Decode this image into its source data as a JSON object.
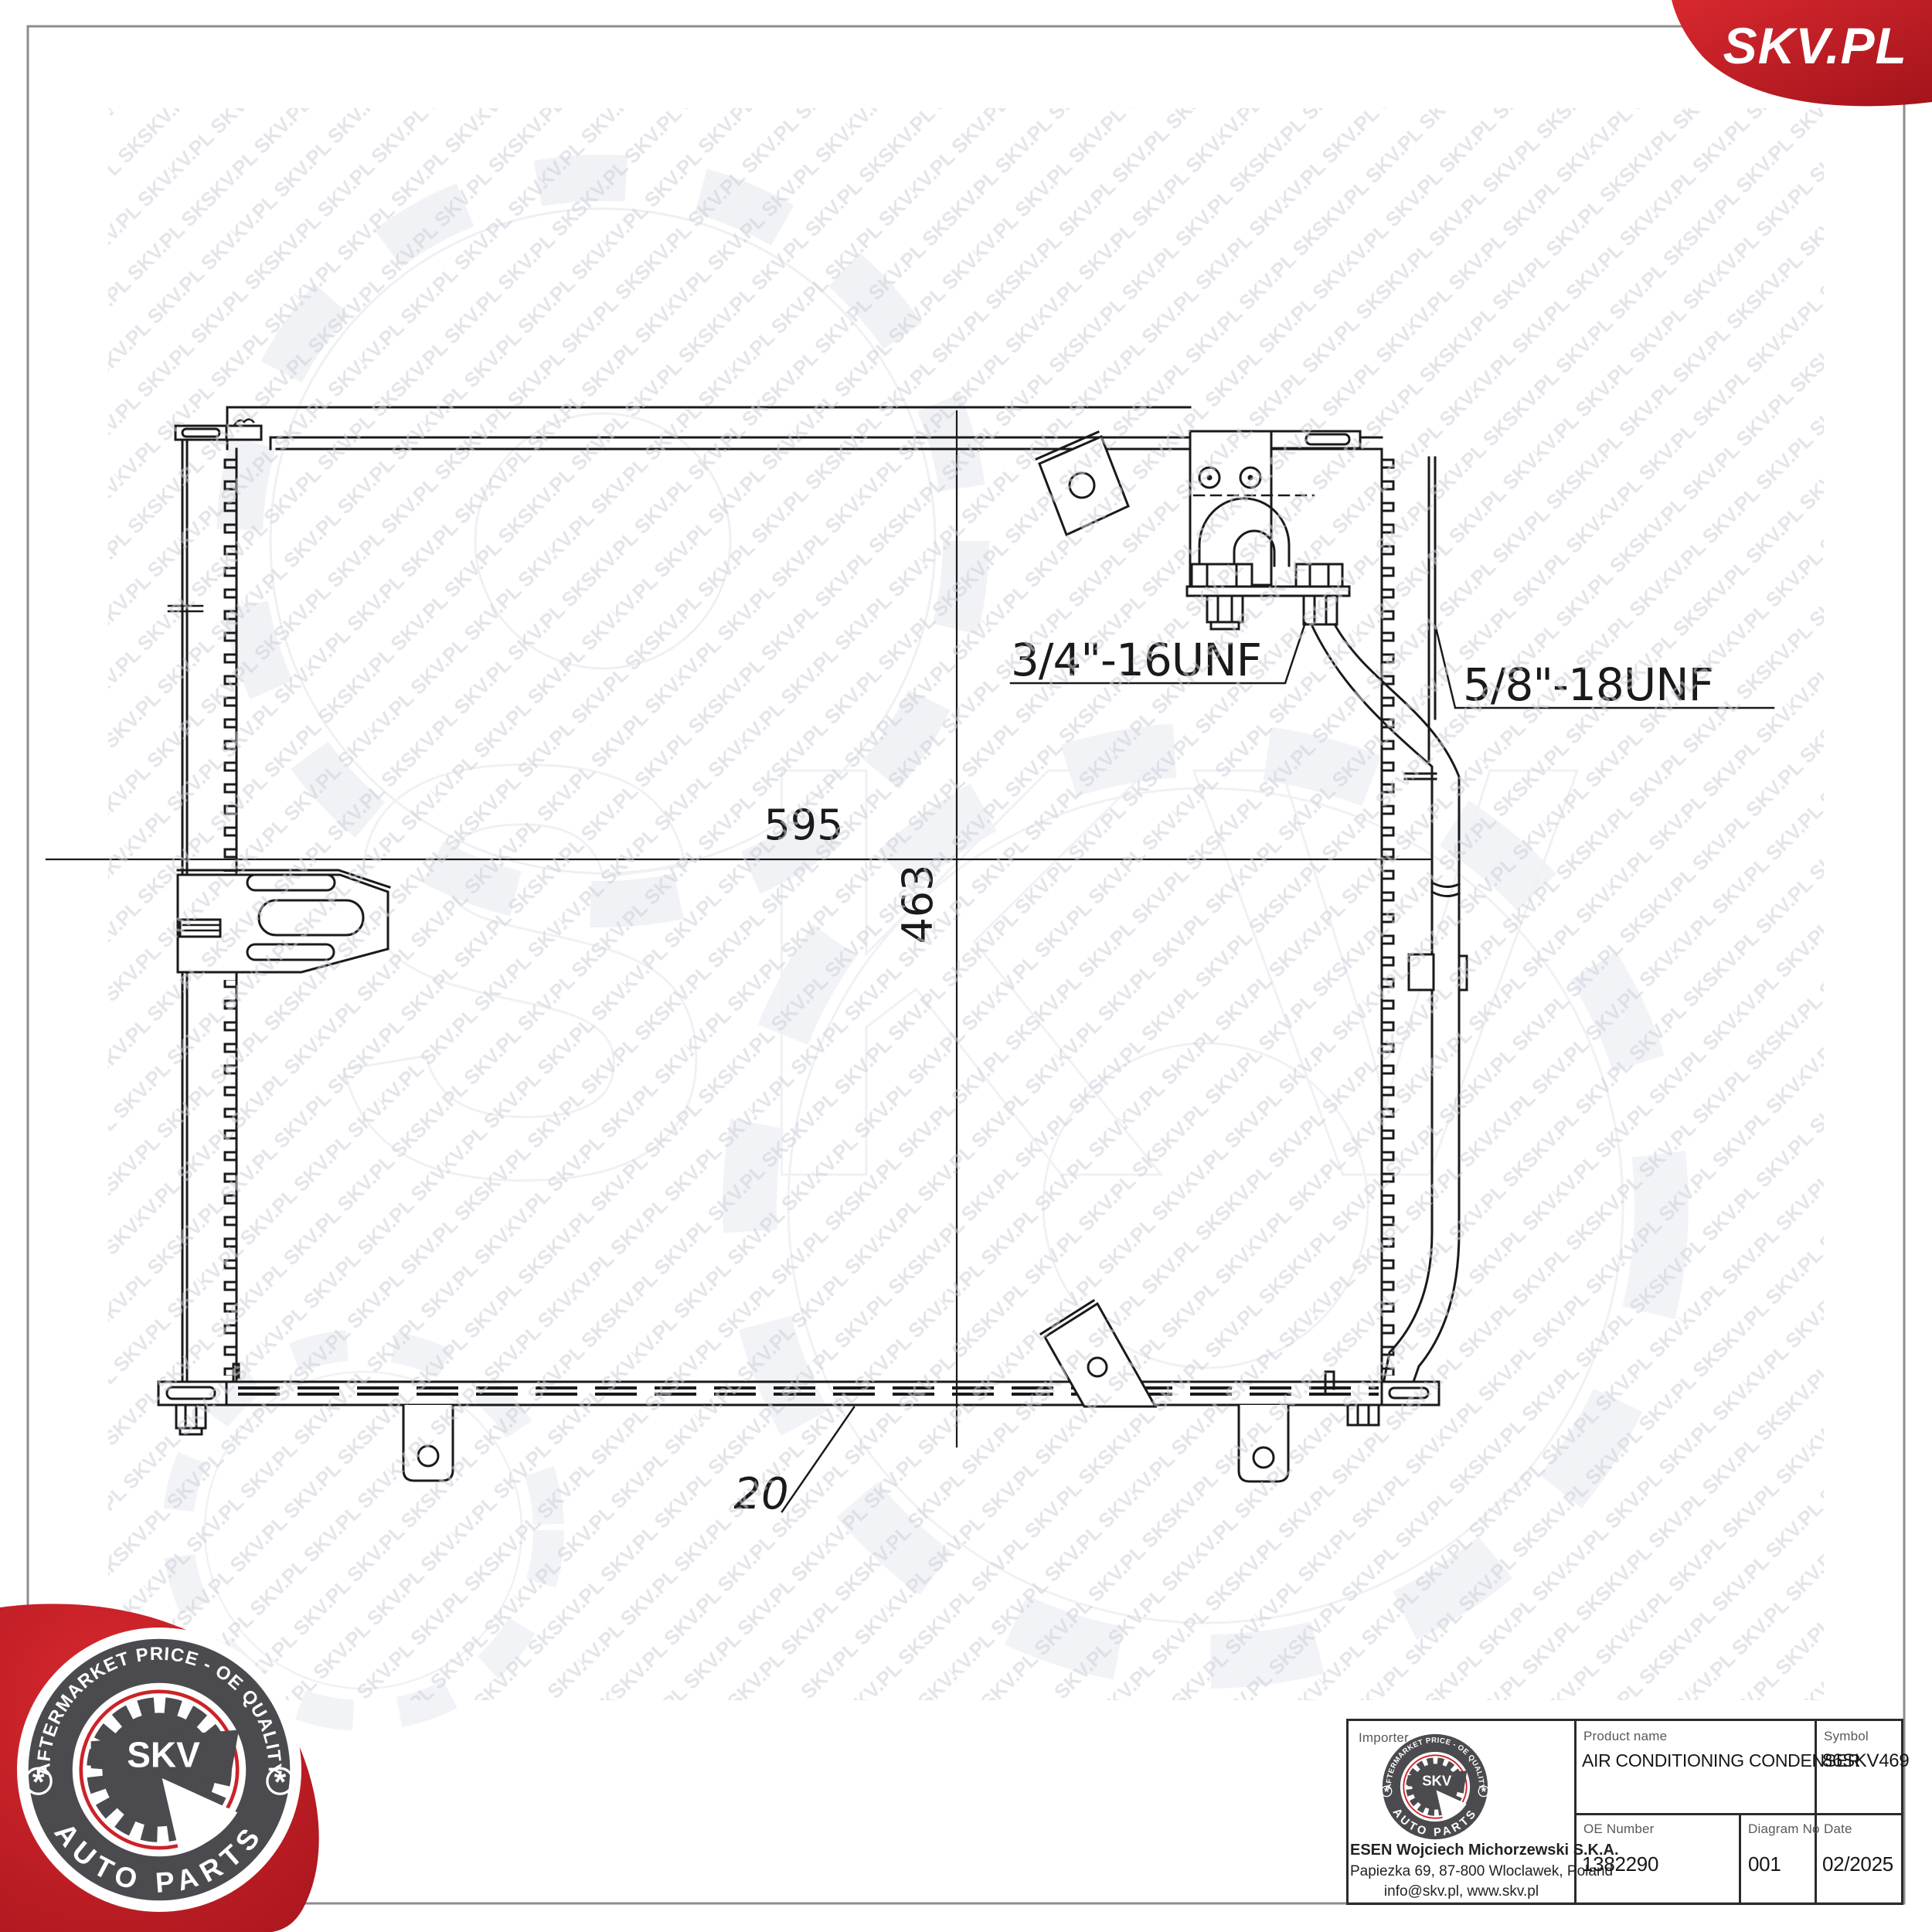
{
  "brand": {
    "logo_text": "SKV.PL",
    "badge_top": "AFTERMARKET PRICE - OE QUALITY",
    "badge_bottom": "AUTO PARTS",
    "badge_center": "SKV",
    "badge_star": "*"
  },
  "watermark": {
    "tile": "SKV.PL SKV.PL SKV.PL SKV.PL SKV.PL",
    "large": "SKV"
  },
  "drawing": {
    "dim_width": "595",
    "dim_height": "463",
    "dim_depth": "20",
    "fitting_large": "3/4\"-16UNF",
    "fitting_small": "5/8\"-18UNF"
  },
  "table": {
    "importer_label": "Importer",
    "importer_name": "ESEN Wojciech Michorzewski S.K.A.",
    "importer_address": "Papiezka 69, 87-800 Wloclawek, Poland",
    "importer_contact": "info@skv.pl, www.skv.pl",
    "product_label": "Product name",
    "product_value": "AIR CONDITIONING CONDENSER",
    "symbol_label": "Symbol",
    "symbol_value": "86SKV469",
    "oe_label": "OE Number",
    "oe_value": "1382290",
    "diagram_label": "Diagram No",
    "diagram_value": "001",
    "date_label": "Date",
    "date_value": "02/2025"
  },
  "colors": {
    "brand_red": "#c8232a",
    "line": "#1a1a1a",
    "frame_gray": "#8d8d8d"
  }
}
